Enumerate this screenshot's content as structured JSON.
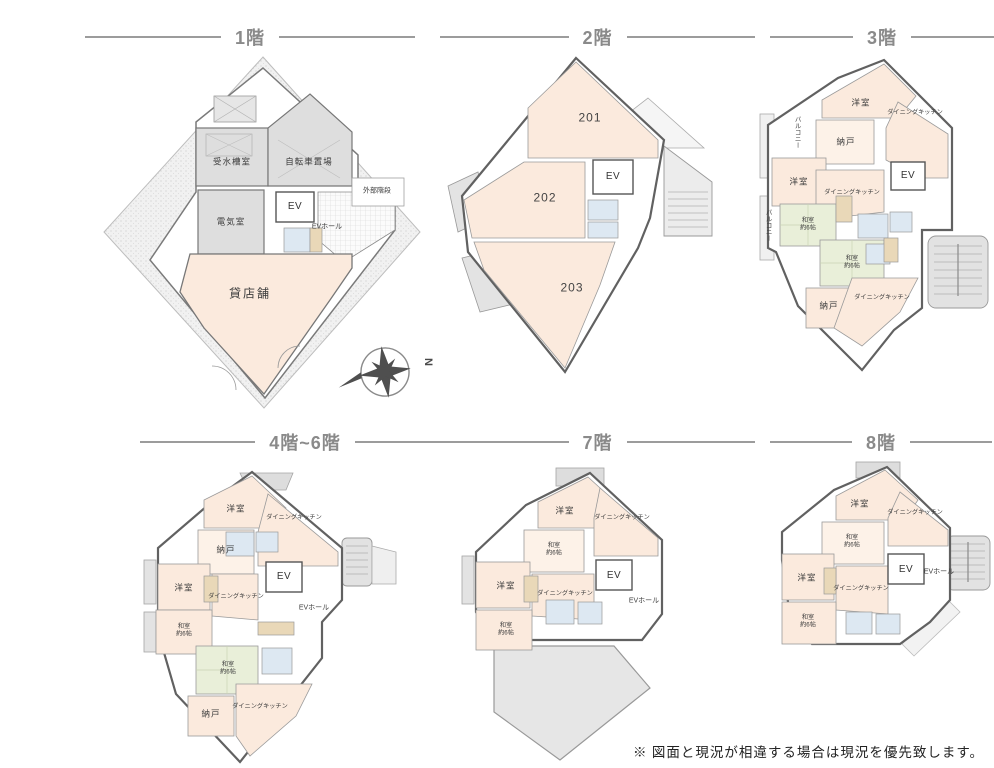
{
  "page": {
    "disclaimer": "※ 図面と現況が相違する場合は現況を優先致します。"
  },
  "palette": {
    "room_pink": "#fbeadd",
    "room_pale": "#fdf2e8",
    "tatami_green": "#e9efd9",
    "utility_gray": "#dedede",
    "terrace_gray": "#e6e6e6",
    "closet_tan": "#e9d8b8",
    "bath_blue": "#dde8f2",
    "wall_gray": "#6b6b6b",
    "header_gray": "#8a8a8a"
  },
  "compass": {
    "north_label": "N"
  },
  "floors": [
    {
      "id": "1f",
      "title": "1階",
      "labels": {
        "water_tank": "受水槽室",
        "bicycle": "自転車置場",
        "electric": "電気室",
        "elevator": "EV",
        "ev_hall": "EVホール",
        "ext_stairs": "外部階段",
        "shop": "貸店舗"
      }
    },
    {
      "id": "2f",
      "title": "2階",
      "labels": {
        "unit201": "201",
        "unit202": "202",
        "unit203": "203",
        "elevator": "EV"
      }
    },
    {
      "id": "3f",
      "title": "3階",
      "labels": {
        "yoshitsu_top": "洋室",
        "dk_top": "ダイニングキッチン",
        "balcony_upper": "バルコニー",
        "nando_top": "納戸",
        "yoshitsu_mid": "洋室",
        "dk_mid": "ダイニングキッチン",
        "elevator": "EV",
        "balcony_lower": "バルコニー",
        "washitsu_a": "和室\n約6帖",
        "washitsu_b": "和室\n約6帖",
        "nando_bottom": "納戸",
        "dk_bottom": "ダイニングキッチン"
      }
    },
    {
      "id": "4-6f",
      "title": "4階~6階",
      "labels": {
        "yoshitsu_top": "洋室",
        "dk_top": "ダイニングキッチン",
        "nando_top": "納戸",
        "elevator": "EV",
        "yoshitsu_mid": "洋室",
        "dk_mid": "ダイニングキッチン",
        "ev_hall": "EVホール",
        "washitsu_a": "和室\n約6帖",
        "washitsu_b": "和室\n約6帖",
        "nando_bottom": "納戸",
        "dk_bottom": "ダイニングキッチン"
      }
    },
    {
      "id": "7f",
      "title": "7階",
      "labels": {
        "yoshitsu_top": "洋室",
        "dk_top": "ダイニングキッチン",
        "washitsu_a": "和室\n約6帖",
        "yoshitsu_mid": "洋室",
        "dk_mid": "ダイニングキッチン",
        "elevator": "EV",
        "ev_hall": "EVホール",
        "washitsu_b": "和室\n約6帖"
      }
    },
    {
      "id": "8f",
      "title": "8階",
      "labels": {
        "yoshitsu_top": "洋室",
        "dk_top": "ダイニングキッチン",
        "washitsu_a": "和室\n約6帖",
        "yoshitsu_mid": "洋室",
        "dk_mid": "ダイニングキッチン",
        "elevator": "EV",
        "ev_hall": "EVホール",
        "washitsu_b": "和室\n約6帖"
      }
    }
  ]
}
